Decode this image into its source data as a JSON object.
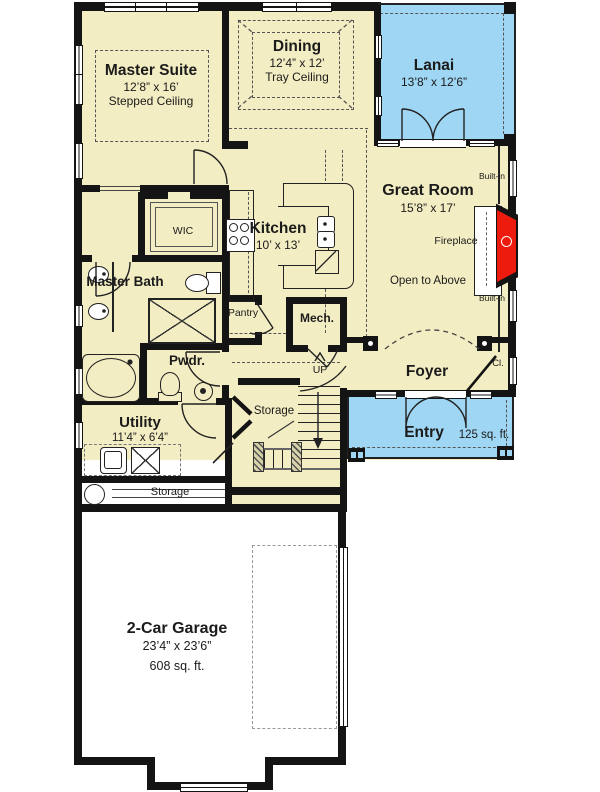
{
  "colors": {
    "floor": "#f3edc3",
    "outdoor": "#9fd6f3",
    "fireplace_red": "#ec1b0e",
    "wall": "#141414"
  },
  "rooms": {
    "master_suite": {
      "name": "Master Suite",
      "dims": "12’8” x 16’",
      "note": "Stepped Ceiling"
    },
    "dining": {
      "name": "Dining",
      "dims": "12’4” x 12’",
      "note": "Tray Ceiling"
    },
    "lanai": {
      "name": "Lanai",
      "dims": "13’8” x 12’6”"
    },
    "great_room": {
      "name": "Great Room",
      "dims": "15’8” x 17’"
    },
    "kitchen": {
      "name": "Kitchen",
      "dims": "10’ x 13’"
    },
    "wic": {
      "name": "WIC"
    },
    "master_bath": {
      "name": "Master Bath"
    },
    "pantry": {
      "name": "Pantry"
    },
    "mech": {
      "name": "Mech."
    },
    "powder": {
      "name": "Pwdr."
    },
    "utility": {
      "name": "Utility",
      "dims": "11’4” x 6’4”"
    },
    "stair_storage": {
      "name": "Storage"
    },
    "shelf_storage": {
      "name": "Storage"
    },
    "foyer": {
      "name": "Foyer"
    },
    "entry": {
      "name": "Entry",
      "area": "125 sq. ft."
    },
    "closet": {
      "name": "Cl."
    },
    "garage": {
      "name": "2-Car Garage",
      "dims": "23’4” x 23’6”",
      "area": "608 sq. ft."
    }
  },
  "annotations": {
    "fireplace": "Fireplace",
    "open_to_above": "Open to Above",
    "built_in": "Built-in",
    "up": "UP"
  }
}
